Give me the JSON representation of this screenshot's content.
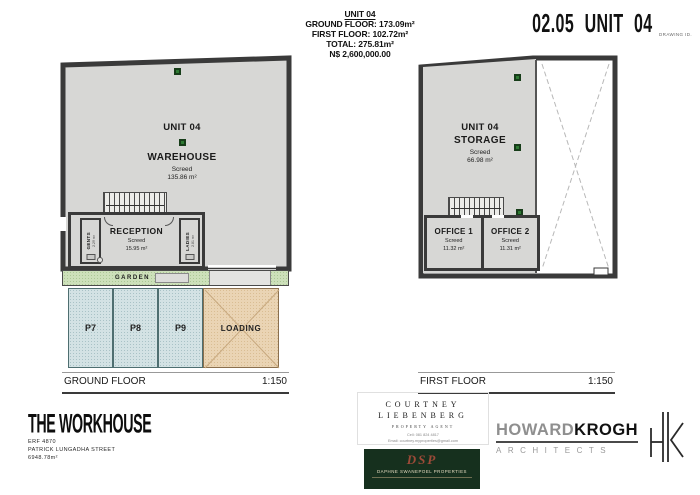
{
  "header": {
    "unit_title": "UNIT 04",
    "ground_floor_line": "GROUND FLOOR: 173.09m²",
    "first_floor_line": "FIRST FLOOR: 102.72m²",
    "total_line": "TOTAL: 275.81m²",
    "price_line": "N$ 2,600,000.00",
    "drawing_number": "02.05 UNIT 04",
    "drawing_id_label": "DRAWING ID."
  },
  "ground_floor": {
    "title": "GROUND FLOOR",
    "scale": "1:150",
    "unit_label": "UNIT 04",
    "room_name": "WAREHOUSE",
    "finish": "Screed",
    "area": "135.86 m²",
    "reception": {
      "name": "RECEPTION",
      "finish": "Screed",
      "area": "15.95 m²"
    },
    "gents": {
      "name": "GENTS",
      "area": "2.29 m²"
    },
    "ladies": {
      "name": "LADIES",
      "area": "2.81 m²"
    },
    "garden_label": "GARDEN",
    "parking_labels": [
      "P7",
      "P8",
      "P9"
    ],
    "loading_label": "LOADING"
  },
  "first_floor": {
    "title": "FIRST FLOOR",
    "scale": "1:150",
    "unit_label": "UNIT 04",
    "room_name": "STORAGE",
    "finish": "Screed",
    "area": "66.98 m²",
    "office1": {
      "name": "OFFICE 1",
      "finish": "Screed",
      "area": "11.32 m²"
    },
    "office2": {
      "name": "OFFICE 2",
      "finish": "Screed",
      "area": "11.31 m²"
    }
  },
  "footer": {
    "project": {
      "name": "THE WORKHOUSE",
      "erf": "ERF 4870",
      "street": "PATRICK LUNGADHA STREET",
      "site_area": "6948.78m²"
    },
    "agent": {
      "first_name": "COURTNEY",
      "last_name": "LIEBENBERG",
      "role": "PROPERTY AGENT",
      "cell_line": "Cell: 081 824 4817",
      "email_line": "Email: courtney.myproperties@gmail.com"
    },
    "developer": {
      "monogram": "DSP",
      "name": "DAPHNE SWANEPOEL PROPERTIES"
    },
    "architect": {
      "name_part1": "HOWARD",
      "name_part2": "KROGH",
      "subtitle": "ARCHITECTS"
    }
  },
  "colors": {
    "wall": "#3a3a3a",
    "floor_fill": "#d7d7d5",
    "garden_green": "#cde0ba",
    "parking_blue": "#d3e2e4",
    "loading_tan": "#ead4b4",
    "marker_green": "#2e7a33",
    "logo_green": "#16301e",
    "logo_monogram_red": "#9c4a38"
  }
}
